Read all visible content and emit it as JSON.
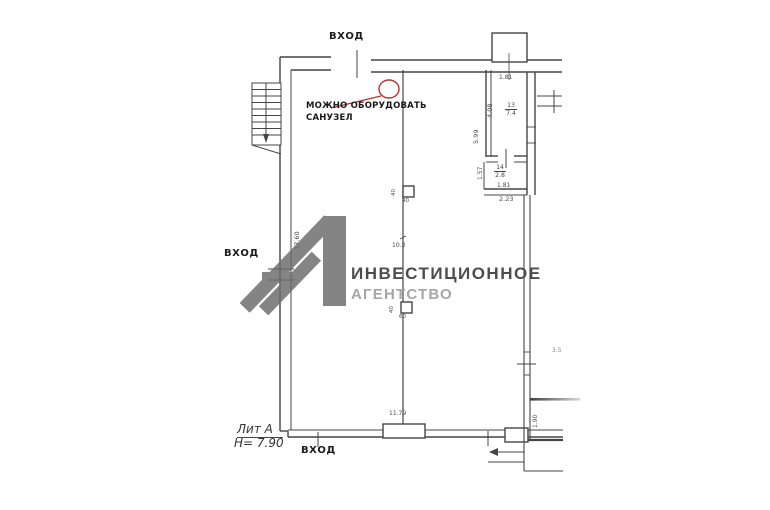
{
  "labels": {
    "entrance_top": "ВХОД",
    "entrance_left": "ВХОД",
    "entrance_bottom": "ВХОД",
    "annotation_line1": "МОЖНО ОБОРУДОВАТЬ",
    "annotation_line2": "САНУЗЕЛ",
    "liter": "Лит А",
    "height": "Н= 7.90"
  },
  "dims": {
    "shaft_width": "1.81",
    "room13_no": "13",
    "room13_area": "7.4",
    "room13_width": "4.08",
    "room13_wall": "5.99",
    "room14_no": "14",
    "room14_area": "2.8",
    "room14_height": "1.57",
    "room14_width": "1.81",
    "room14_outer": "2.23",
    "left_wall": "17.60",
    "col_top_a": "40",
    "col_top_b": "40",
    "center_span": "10.3",
    "col_mid_a": "40",
    "col_mid_b": "60",
    "bottom_span": "11.79",
    "right_upper": "3.5",
    "right_lower": "1.90"
  },
  "watermark": {
    "numeral": "1",
    "line1": "ИНВЕСТИЦИОННОЕ",
    "line2": "АГЕНТСТВО"
  },
  "colors": {
    "plan_line": "#454545",
    "annotation_red": "#b5342e",
    "logo_mark": "#6a6a6a",
    "logo_text_primary": "#4d4d4d",
    "logo_text_secondary": "#a6a6a6"
  }
}
